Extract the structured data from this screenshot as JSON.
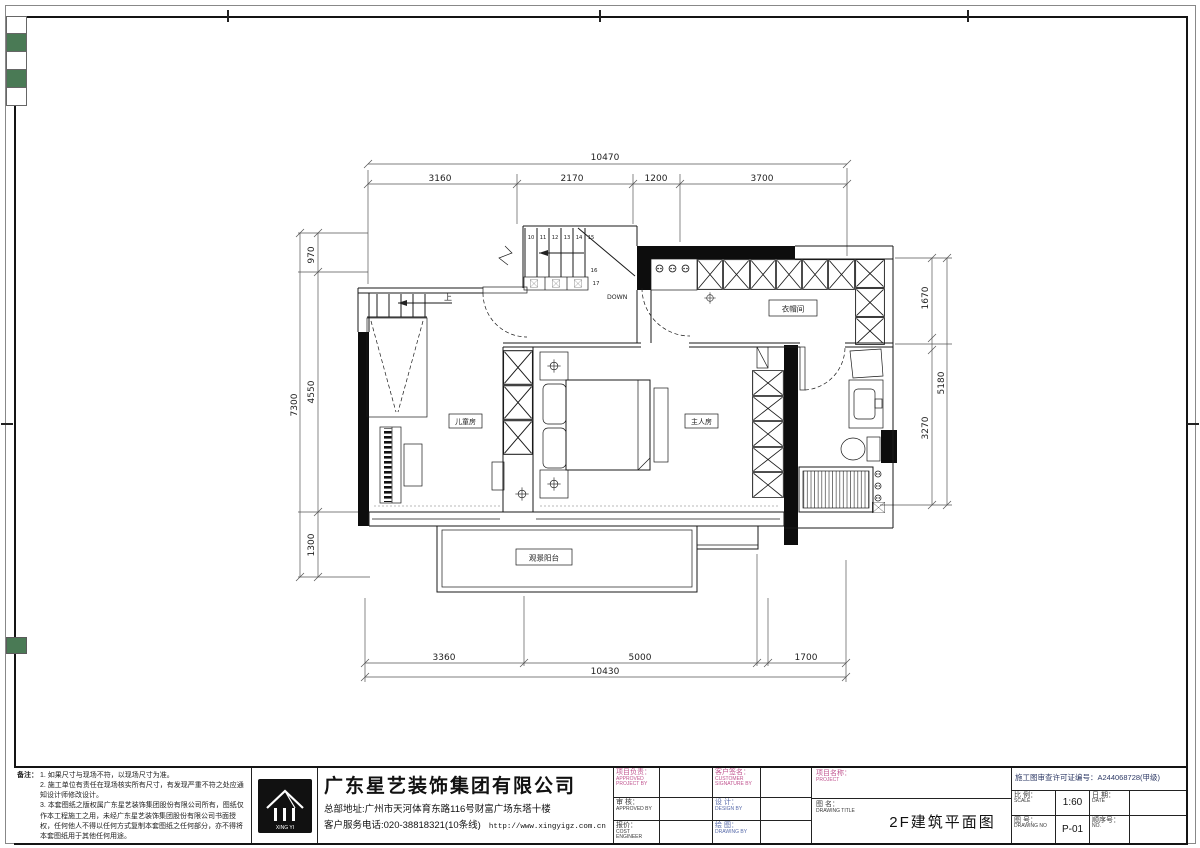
{
  "colors": {
    "accent_pink": "#c0548f",
    "accent_blue": "#5568a8",
    "marker_green": "#4a7a55",
    "license_navy": "#2e3a66",
    "line_black": "#1a1a1a"
  },
  "notes": {
    "label": "备注：",
    "items": [
      "1. 如果尺寸与现场不符，以现场尺寸为准。",
      "2. 施工单位有责任在现场核实所有尺寸，有发现严重不符之处应通知设计师修改设计。",
      "3. 本套图纸之版权属广东星艺装饰集团股份有限公司所有，图纸仅作本工程施工之用，未经广东星艺装饰集团股份有限公司书面授权，任何他人不得以任何方式复制本套图纸之任何部分，亦不得将本套图纸用于其他任何用途。"
    ]
  },
  "company": {
    "name": "广东星艺装饰集团有限公司",
    "address": "总部地址:广州市天河体育东路116号财富广场东塔十楼",
    "phone": "客户服务电话:020-38818321(10条线)",
    "url": "http://www.xingyigz.com.cn",
    "logo_text": "XING YI"
  },
  "titleblock": {
    "project_lead": {
      "cn": "项目负责：",
      "en": "APPROVED PROJECT BY"
    },
    "customer": {
      "cn": "客户签名：",
      "en": "CUSTOMER SIGNATURE BY"
    },
    "check": {
      "cn": "审 核：",
      "en": "APPROVED BY"
    },
    "design": {
      "cn": "设 计：",
      "en": "DESIGN BY"
    },
    "quote": {
      "cn": "报价：",
      "en": "Cost Engineer"
    },
    "draw": {
      "cn": "绘 图：",
      "en": "DRAWING BY"
    },
    "project_name": {
      "cn": "项目名称：",
      "en": "PROJECT"
    },
    "drawing_title": {
      "cn": "图 名：",
      "en": "DRAWING TITLE",
      "value": "2F建筑平面图"
    },
    "license": {
      "label": "施工图审查许可证编号：",
      "value": "A244068728(甲级)"
    },
    "scale": {
      "cn": "比 例：",
      "en": "SCALE",
      "value": "1:60"
    },
    "date": {
      "cn": "日 期：",
      "en": "DATE"
    },
    "number": {
      "cn": "图 号：",
      "en": "DRAWING No",
      "value": "P-01"
    },
    "seq": {
      "cn": "顺序号：",
      "en": "NO."
    }
  },
  "plan": {
    "rooms": {
      "children": "儿童房",
      "master": "主人房",
      "closet": "衣帽间",
      "balcony": "观景阳台"
    },
    "stair": {
      "numbers": [
        "10",
        "11",
        "12",
        "13",
        "14",
        "15"
      ],
      "n16": "16",
      "n17": "17",
      "down": "DOWN",
      "up": "上"
    },
    "dims": {
      "top": {
        "total": "10470",
        "segments": [
          "3160",
          "2170",
          "1200",
          "3700"
        ]
      },
      "bottom": {
        "total": "10430",
        "segments": [
          "3360",
          "5000",
          "1700"
        ]
      },
      "left": {
        "total": "7300",
        "segments": [
          "970",
          "4550",
          "1300"
        ]
      },
      "right": {
        "total": "5180",
        "segments": [
          "1670",
          "3270"
        ]
      }
    }
  }
}
